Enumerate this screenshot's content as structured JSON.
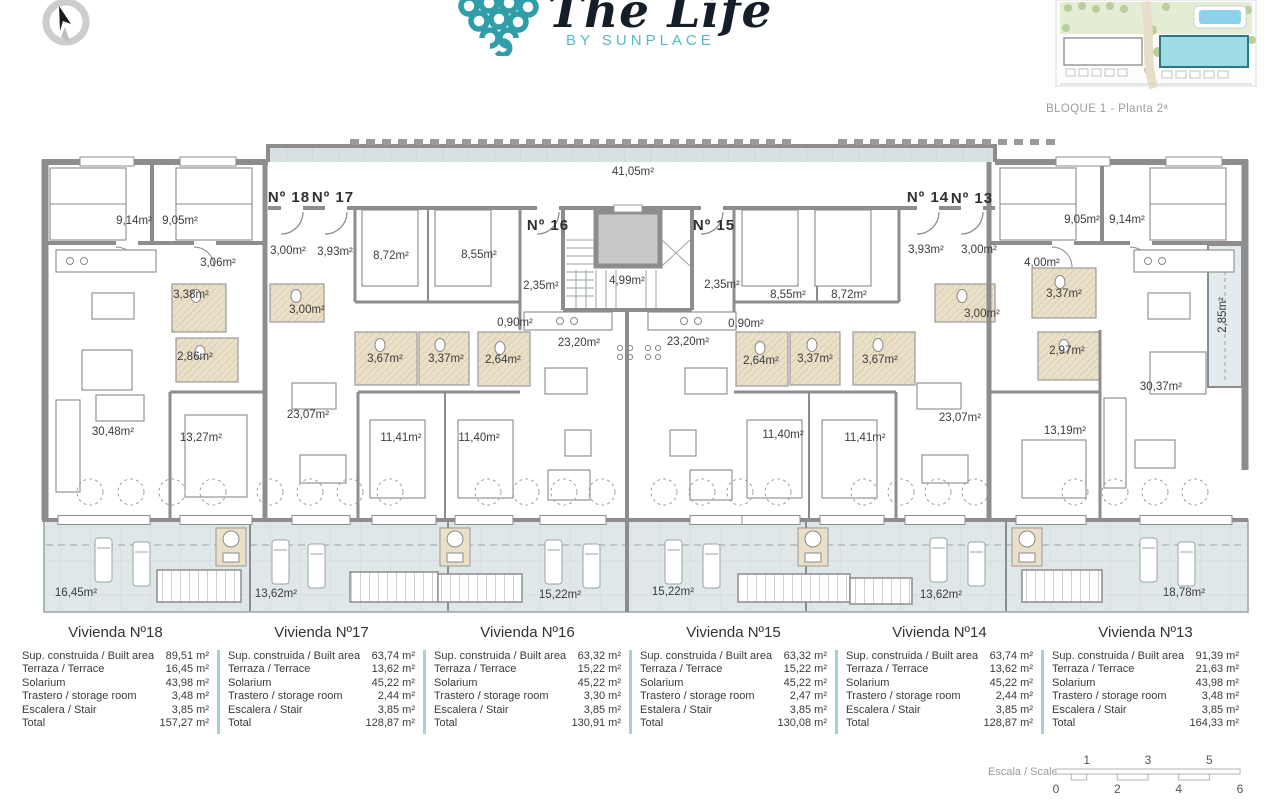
{
  "header": {
    "brand_script": "The Life",
    "brand_sub": "BY SUNPLACE",
    "block_label": "BLOQUE 1 - Planta 2ª"
  },
  "colors": {
    "brand_teal": "#2f9ea9",
    "brand_teal_light": "#54bcc4",
    "wall_gray": "#8d8d8d",
    "terrace_tint": "#dfe7e9",
    "solarium_tint": "#d7e0e3",
    "bath_tan": "#eadfc8",
    "table_divider": "#a9ced8",
    "label_gray": "#9d9d9d"
  },
  "plan": {
    "apartment_labels": [
      {
        "text": "Nº 18",
        "x": 289,
        "y": 202
      },
      {
        "text": "Nº 17",
        "x": 333,
        "y": 202
      },
      {
        "text": "Nº 16",
        "x": 548,
        "y": 230
      },
      {
        "text": "Nº 15",
        "x": 714,
        "y": 230
      },
      {
        "text": "Nº 14",
        "x": 928,
        "y": 202
      },
      {
        "text": "Nº 13",
        "x": 972,
        "y": 203
      }
    ],
    "room_labels": [
      {
        "text": "9,14m²",
        "x": 134,
        "y": 224
      },
      {
        "text": "9,05m²",
        "x": 180,
        "y": 224
      },
      {
        "text": "3,06m²",
        "x": 218,
        "y": 266
      },
      {
        "text": "3,00m²",
        "x": 288,
        "y": 254
      },
      {
        "text": "3,93m²",
        "x": 335,
        "y": 255
      },
      {
        "text": "8,72m²",
        "x": 391,
        "y": 259
      },
      {
        "text": "8,55m²",
        "x": 479,
        "y": 258
      },
      {
        "text": "3,38m²",
        "x": 191,
        "y": 298
      },
      {
        "text": "3,00m²",
        "x": 307,
        "y": 313
      },
      {
        "text": "2,86m²",
        "x": 195,
        "y": 360
      },
      {
        "text": "3,67m²",
        "x": 385,
        "y": 362
      },
      {
        "text": "3,37m²",
        "x": 446,
        "y": 362
      },
      {
        "text": "41,05m²",
        "x": 633,
        "y": 175
      },
      {
        "text": "2,35m²",
        "x": 541,
        "y": 289
      },
      {
        "text": "4,99m²",
        "x": 627,
        "y": 284
      },
      {
        "text": "2,35m²",
        "x": 722,
        "y": 288
      },
      {
        "text": "0,90m²",
        "x": 515,
        "y": 326
      },
      {
        "text": "0,90m²",
        "x": 746,
        "y": 327
      },
      {
        "text": "23,20m²",
        "x": 579,
        "y": 346
      },
      {
        "text": "23,20m²",
        "x": 688,
        "y": 345
      },
      {
        "text": "2,64m²",
        "x": 503,
        "y": 363
      },
      {
        "text": "2,64m²",
        "x": 761,
        "y": 364
      },
      {
        "text": "3,37m²",
        "x": 815,
        "y": 362
      },
      {
        "text": "3,67m²",
        "x": 880,
        "y": 363
      },
      {
        "text": "8,55m²",
        "x": 788,
        "y": 298
      },
      {
        "text": "8,72m²",
        "x": 849,
        "y": 298
      },
      {
        "text": "3,93m²",
        "x": 926,
        "y": 253
      },
      {
        "text": "3,00m²",
        "x": 979,
        "y": 253
      },
      {
        "text": "4,00m²",
        "x": 1042,
        "y": 266
      },
      {
        "text": "9,05m²",
        "x": 1082,
        "y": 223
      },
      {
        "text": "9,14m²",
        "x": 1127,
        "y": 223
      },
      {
        "text": "3,37m²",
        "x": 1064,
        "y": 297
      },
      {
        "text": "3,00m²",
        "x": 982,
        "y": 317
      },
      {
        "text": "2,97m²",
        "x": 1067,
        "y": 354
      },
      {
        "text": "2,85m²",
        "x": 1226,
        "y": 315,
        "rot": -90
      },
      {
        "text": "30,48m²",
        "x": 113,
        "y": 435
      },
      {
        "text": "13,27m²",
        "x": 201,
        "y": 441
      },
      {
        "text": "23,07m²",
        "x": 308,
        "y": 418
      },
      {
        "text": "11,41m²",
        "x": 401,
        "y": 441
      },
      {
        "text": "11,40m²",
        "x": 479,
        "y": 441
      },
      {
        "text": "11,40m²",
        "x": 783,
        "y": 438
      },
      {
        "text": "11,41m²",
        "x": 865,
        "y": 441
      },
      {
        "text": "23,07m²",
        "x": 960,
        "y": 421
      },
      {
        "text": "13,19m²",
        "x": 1065,
        "y": 434
      },
      {
        "text": "30,37m²",
        "x": 1161,
        "y": 390
      },
      {
        "text": "16,45m²",
        "x": 76,
        "y": 596
      },
      {
        "text": "13,62m²",
        "x": 276,
        "y": 597
      },
      {
        "text": "15,22m²",
        "x": 560,
        "y": 598
      },
      {
        "text": "15,22m²",
        "x": 673,
        "y": 595
      },
      {
        "text": "13,62m²",
        "x": 941,
        "y": 598
      },
      {
        "text": "18,78m²",
        "x": 1184,
        "y": 596
      }
    ]
  },
  "tables": [
    {
      "title": "Vivienda Nº18",
      "rows": [
        [
          "Sup. construida / Built area",
          "89,51 m²"
        ],
        [
          "Terraza / Terrace",
          "16,45 m²"
        ],
        [
          "Solarium",
          "43,98 m²"
        ],
        [
          "Trastero / storage room",
          "3,48 m²"
        ],
        [
          "Escalera / Stair",
          "3,85 m²"
        ],
        [
          "Total",
          "157,27 m²"
        ]
      ]
    },
    {
      "title": "Vivienda Nº17",
      "rows": [
        [
          "Sup. construida / Built area",
          "63,74 m²"
        ],
        [
          "Terraza / Terrace",
          "13,62 m²"
        ],
        [
          "Solarium",
          "45,22 m²"
        ],
        [
          "Trastero / storage room",
          "2,44 m²"
        ],
        [
          "Escalera / Stair",
          "3,85 m²"
        ],
        [
          "Total",
          "128,87 m²"
        ]
      ]
    },
    {
      "title": "Vivienda Nº16",
      "rows": [
        [
          "Sup. construida / Built area",
          "63,32 m²"
        ],
        [
          "Terraza / Terrace",
          "15,22 m²"
        ],
        [
          "Solarium",
          "45,22 m²"
        ],
        [
          "Trastero / storage room",
          "3,30 m²"
        ],
        [
          "Escalera / Stair",
          "3,85 m²"
        ],
        [
          "Total",
          "130,91 m²"
        ]
      ]
    },
    {
      "title": "Vivienda Nº15",
      "rows": [
        [
          "Sup. construida / Built area",
          "63,32 m²"
        ],
        [
          "Terraza / Terrace",
          "15,22 m²"
        ],
        [
          "Solarium",
          "45,22 m²"
        ],
        [
          "Trastero / storage room",
          "2,47 m²"
        ],
        [
          "Estalera / Stair",
          "3,85 m²"
        ],
        [
          "Total",
          "130,08 m²"
        ]
      ]
    },
    {
      "title": "Vivienda Nº14",
      "rows": [
        [
          "Sup. construida / Built area",
          "63,74 m²"
        ],
        [
          "Terraza / Terrace",
          "13,62 m²"
        ],
        [
          "Solarium",
          "45,22 m²"
        ],
        [
          "Trastero / storage room",
          "2,44 m²"
        ],
        [
          "Escalera / Stair",
          "3,85 m²"
        ],
        [
          "Total",
          "128,87 m²"
        ]
      ]
    },
    {
      "title": "Vivienda Nº13",
      "rows": [
        [
          "Sup. construida / Built area",
          "91,39 m²"
        ],
        [
          "Terraza / Terrace",
          "21,63 m²"
        ],
        [
          "Solarium",
          "43,98 m²"
        ],
        [
          "Trastero / storage room",
          "3,48 m²"
        ],
        [
          "Escalera / Stair",
          "3,85 m²"
        ],
        [
          "Total",
          "164,33 m²"
        ]
      ]
    }
  ],
  "scale": {
    "label": "Escala / Scale",
    "top_numbers": [
      "1",
      "3",
      "5"
    ],
    "bottom_numbers": [
      "0",
      "2",
      "4",
      "6"
    ]
  }
}
